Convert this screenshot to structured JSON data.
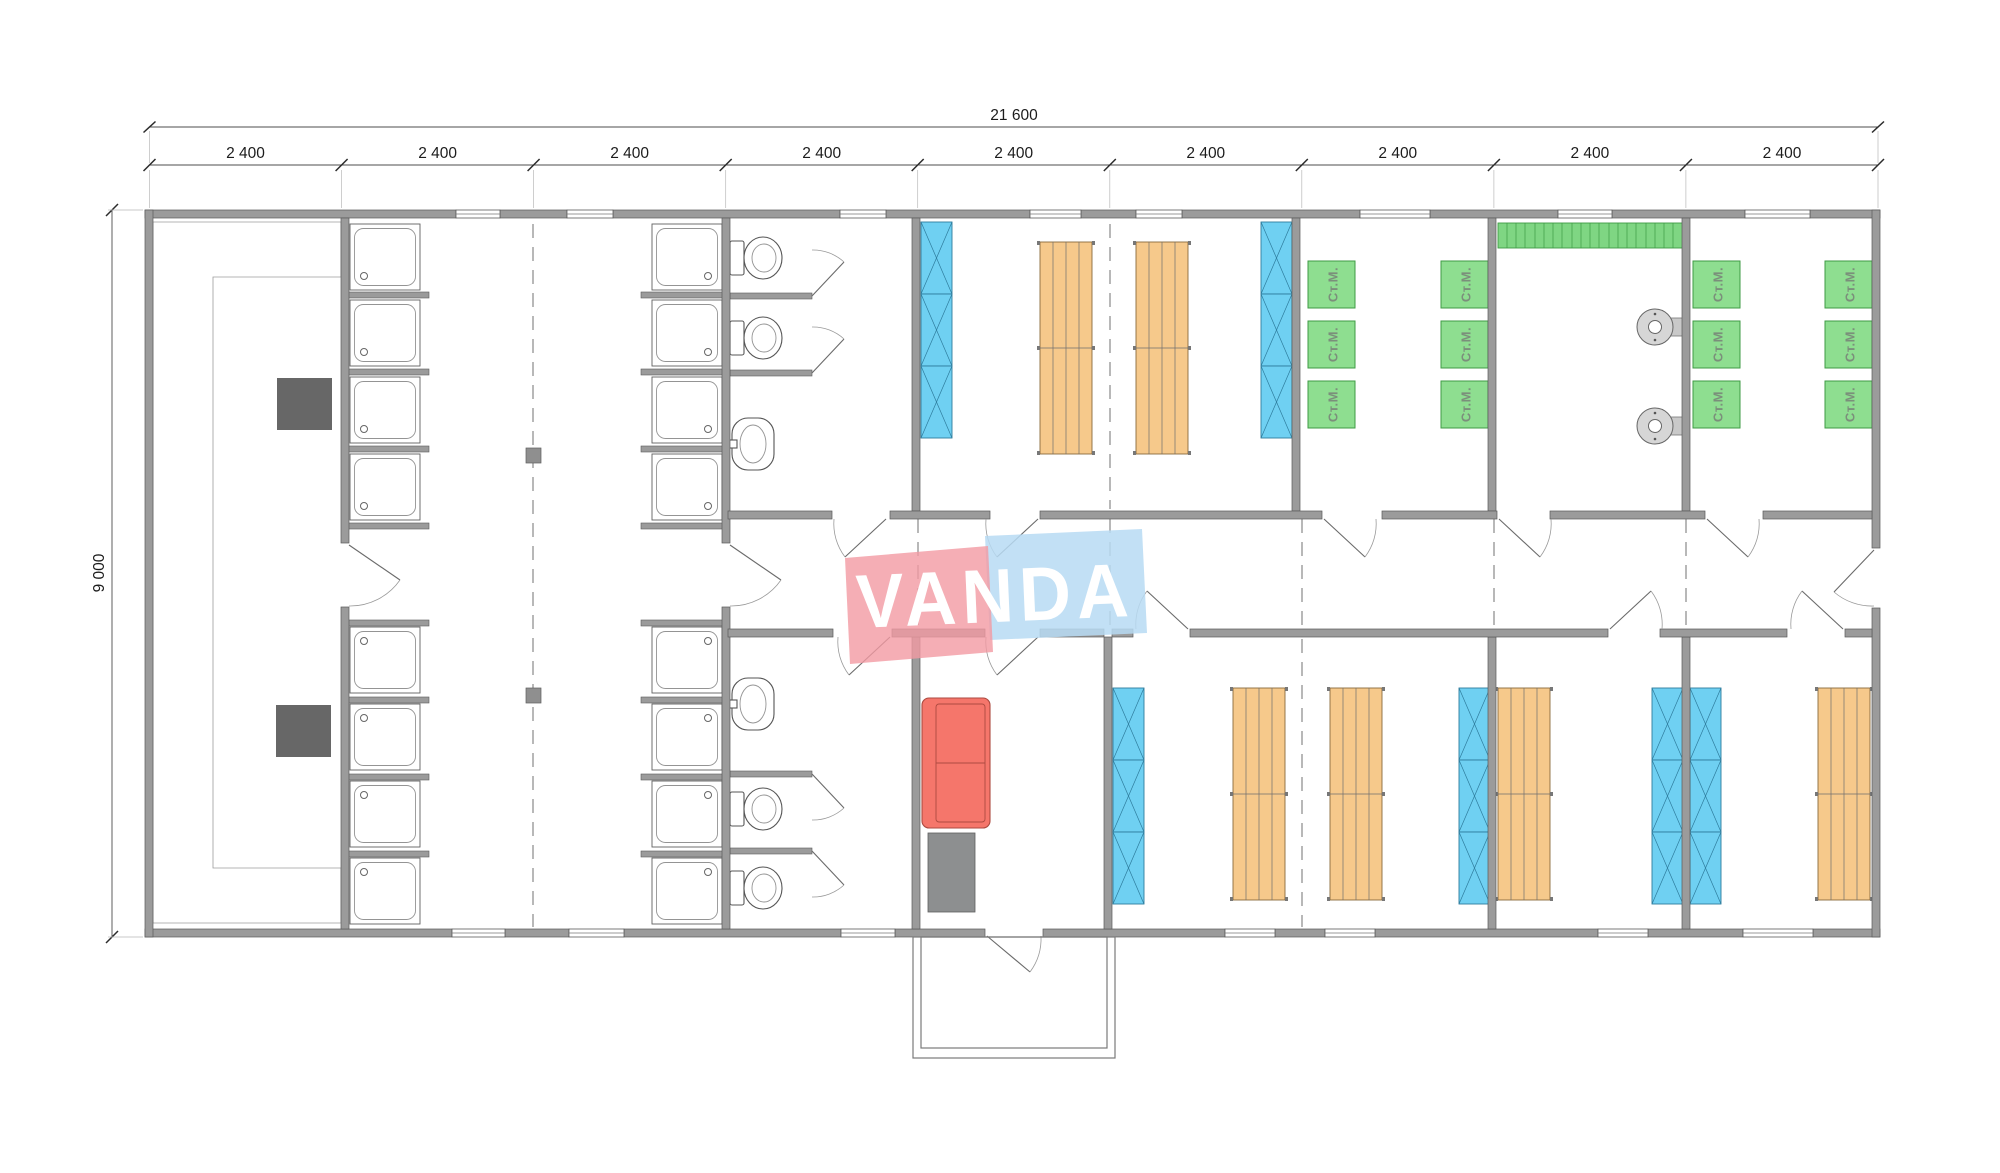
{
  "plan": {
    "watermark_text": "VANDA",
    "dim_total_width": "21 600",
    "dim_total_height": "9 000",
    "dim_modules": [
      "2 400",
      "2 400",
      "2 400",
      "2 400",
      "2 400",
      "2 400",
      "2 400",
      "2 400",
      "2 400"
    ],
    "appliance_label_washing_machine": "Ст.М."
  },
  "colors": {
    "wall": "#9b9b9b",
    "wallStroke": "#5a5a5a",
    "locker": "#6fd0f2",
    "lockerStroke": "#2e7c9d",
    "bunk": "#f6c98b",
    "bunkStroke": "#8a6a3c",
    "machine": "#8ede90",
    "machineStroke": "#3f9b45",
    "machineText": "#7b8f7b",
    "bench": "#7fd683",
    "sofa": "#f5766b",
    "sofaStroke": "#ad4a40",
    "table": "#8d8f90",
    "darkTable": "#676767",
    "dash": "#9a9a9a",
    "dim": "#4d4d4d",
    "logoPink": "rgba(242,154,163,0.8)",
    "logoBlue": "rgba(183,219,243,0.85)",
    "logoText": "#ffffff"
  }
}
